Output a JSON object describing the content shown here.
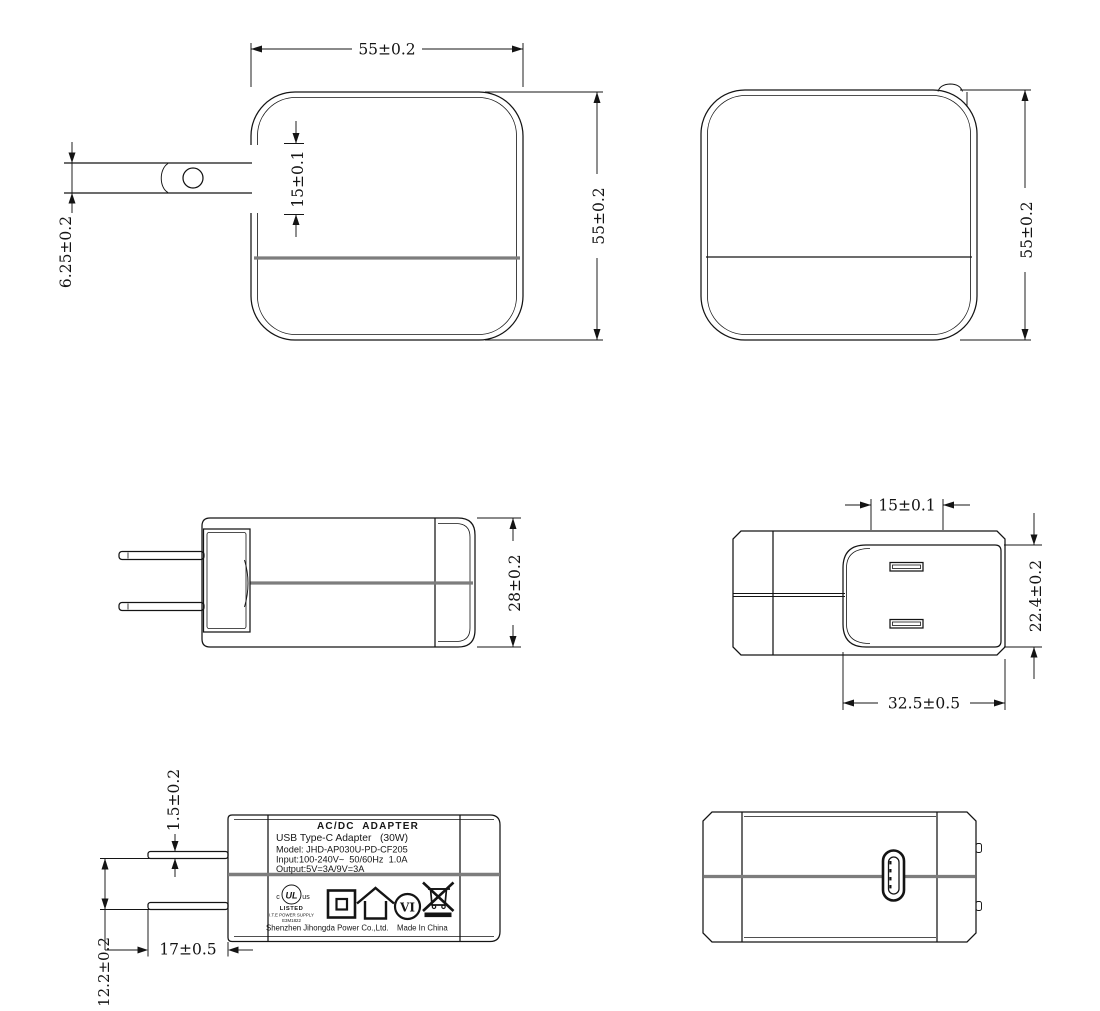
{
  "palette": {
    "line": "#141414",
    "seam_gray": "#7d7d7d",
    "background": "#ffffff"
  },
  "views": {
    "front": {
      "dim_width": "55±0.2",
      "dim_height": "55±0.2",
      "dim_blade_recess": "15±0.1",
      "dim_blade_width": "6.25±0.2"
    },
    "back": {
      "dim_height": "55±0.2"
    },
    "side": {
      "dim_depth": "28±0.2"
    },
    "top": {
      "dim_blade_gap": "15±0.1",
      "dim_plug_base_width": "22.4±0.2",
      "dim_plug_base_length": "32.5±0.5"
    },
    "label": {
      "dim_blade_thickness": "1.5±0.2",
      "dim_blade_spacing": "12.2±0.2",
      "dim_blade_length": "17±0.5",
      "text": {
        "title": "AC/DC  ADAPTER",
        "subtitle": "USB Type-C Adapter   (30W)",
        "model": "Model: JHD-AP030U-PD-CF205",
        "input": "Input:100-240V~  50/60Hz  1.0A",
        "output": "Output:5V=3A/9V=3A",
        "company": "Shenzhen Jihongda Power Co.,Ltd.",
        "made_in": "Made In China"
      },
      "cert": {
        "c": "c",
        "ul": "UL",
        "us": "us",
        "listed": "LISTED",
        "category": "I.T.E POWER SUPPLY",
        "file_no": "E3M1822",
        "efficiency": "VI"
      }
    }
  }
}
